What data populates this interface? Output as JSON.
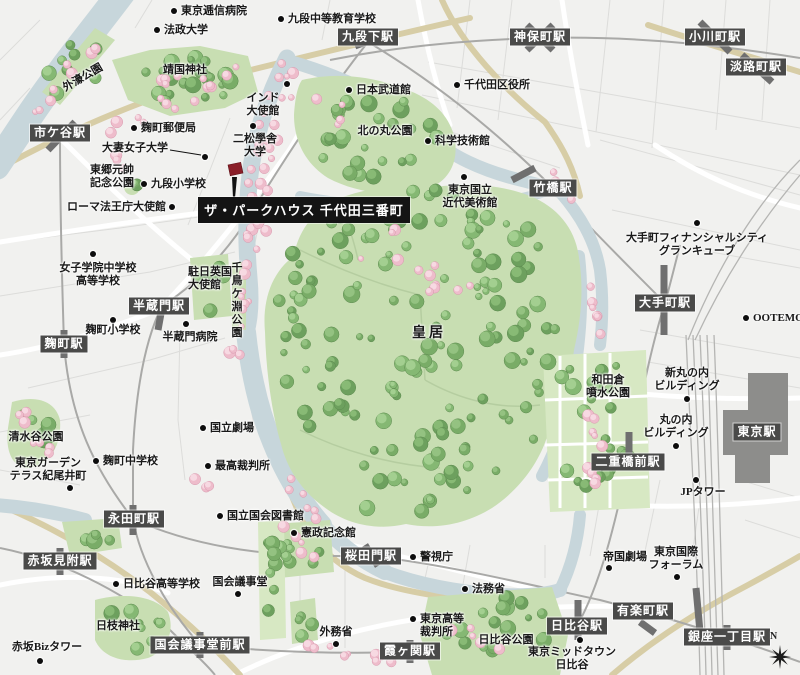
{
  "property": {
    "name": "ザ・パークハウス 千代田三番町",
    "marker_color": "#8a1e28"
  },
  "compass_label": "N",
  "colors": {
    "station_badge": "#4a4a49",
    "water": "#c7d6db",
    "park": "#c8deb2",
    "lawn": "#d7e8c3",
    "tree": "#79ac67",
    "sakura": "#eebccb",
    "major_road": "#d7cda6",
    "railway": "#a9a9a7",
    "station_block": "#8d8d8b",
    "text": "#191919"
  },
  "stations": [
    {
      "id": "ichigaya",
      "label": "市ケ谷駅",
      "x": 60,
      "y": 133
    },
    {
      "id": "kudanshita",
      "label": "九段下駅",
      "x": 368,
      "y": 37
    },
    {
      "id": "jimbocho",
      "label": "神保町駅",
      "x": 540,
      "y": 37
    },
    {
      "id": "ogawamachi",
      "label": "小川町駅",
      "x": 715,
      "y": 37
    },
    {
      "id": "awajicho",
      "label": "淡路町駅",
      "x": 756,
      "y": 67
    },
    {
      "id": "takebashi",
      "label": "竹橋駅",
      "x": 553,
      "y": 188
    },
    {
      "id": "otemachi",
      "label": "大手町駅",
      "x": 665,
      "y": 303
    },
    {
      "id": "tokyo",
      "label": "東京駅",
      "x": 757,
      "y": 432
    },
    {
      "id": "nijubashimae",
      "label": "二重橋前駅",
      "x": 628,
      "y": 462
    },
    {
      "id": "hanzomon",
      "label": "半蔵門駅",
      "x": 159,
      "y": 306
    },
    {
      "id": "kojimachi",
      "label": "麹町駅",
      "x": 64,
      "y": 344
    },
    {
      "id": "nagatacho",
      "label": "永田町駅",
      "x": 134,
      "y": 519
    },
    {
      "id": "akasaka-mitsuke",
      "label": "赤坂見附駅",
      "x": 60,
      "y": 561
    },
    {
      "id": "sakuradamon",
      "label": "桜田門駅",
      "x": 371,
      "y": 556
    },
    {
      "id": "kokkai-gijidomae",
      "label": "国会議事堂前駅",
      "x": 200,
      "y": 645
    },
    {
      "id": "kasumigaseki",
      "label": "霞ヶ関駅",
      "x": 410,
      "y": 651
    },
    {
      "id": "yurakucho",
      "label": "有楽町駅",
      "x": 643,
      "y": 611
    },
    {
      "id": "hibiya",
      "label": "日比谷駅",
      "x": 577,
      "y": 626
    },
    {
      "id": "ginza-itchome",
      "label": "銀座一丁目駅",
      "x": 727,
      "y": 637
    }
  ],
  "landmarks": [
    {
      "id": "tokyo-teishin-hospital",
      "lines": [
        "東京逓信病院"
      ],
      "tx": 181,
      "ty": 5,
      "align": "l",
      "dot": [
        174,
        11
      ]
    },
    {
      "id": "hosei-university",
      "lines": [
        "法政大学"
      ],
      "tx": 164,
      "ty": 24,
      "align": "l",
      "dot": [
        157,
        30
      ]
    },
    {
      "id": "kudan-secondary-school",
      "lines": [
        "九段中等教育学校"
      ],
      "tx": 288,
      "ty": 13,
      "align": "l",
      "dot": [
        281,
        19
      ]
    },
    {
      "id": "chiyoda-ward-office",
      "lines": [
        "千代田区役所"
      ],
      "tx": 464,
      "ty": 79,
      "align": "l",
      "dot": [
        457,
        85
      ]
    },
    {
      "id": "science-museum",
      "lines": [
        "科学技術館"
      ],
      "tx": 435,
      "ty": 135,
      "align": "l",
      "dot": [
        428,
        141
      ]
    },
    {
      "id": "kojimachi-post-office",
      "lines": [
        "麹町郵便局"
      ],
      "tx": 141,
      "ty": 122,
      "align": "l",
      "dot": [
        134,
        128
      ]
    },
    {
      "id": "kudan-elementary-school",
      "lines": [
        "九段小学校"
      ],
      "tx": 151,
      "ty": 178,
      "align": "l",
      "dot": [
        144,
        184
      ]
    },
    {
      "id": "nippon-budokan",
      "lines": [
        "日本武道館"
      ],
      "tx": 356,
      "ty": 84,
      "align": "l",
      "dot": [
        349,
        90
      ]
    },
    {
      "id": "ootemori",
      "lines": [
        "OOTEMORI"
      ],
      "tx": 753,
      "ty": 312,
      "align": "l",
      "dot": [
        746,
        318
      ]
    },
    {
      "id": "kojimachi-junior-high",
      "lines": [
        "麹町中学校"
      ],
      "tx": 103,
      "ty": 455,
      "align": "l",
      "dot": [
        96,
        461
      ]
    },
    {
      "id": "national-theatre",
      "lines": [
        "国立劇場"
      ],
      "tx": 210,
      "ty": 422,
      "align": "l",
      "dot": [
        203,
        428
      ]
    },
    {
      "id": "supreme-court",
      "lines": [
        "最高裁判所"
      ],
      "tx": 215,
      "ty": 460,
      "align": "l",
      "dot": [
        208,
        466
      ]
    },
    {
      "id": "national-diet-library",
      "lines": [
        "国立国会図書館"
      ],
      "tx": 227,
      "ty": 510,
      "align": "l",
      "dot": [
        220,
        516
      ]
    },
    {
      "id": "kensei-memorial-hall",
      "lines": [
        "憲政記念館"
      ],
      "tx": 301,
      "ty": 527,
      "align": "l",
      "dot": [
        294,
        533
      ]
    },
    {
      "id": "metropolitan-police-hq",
      "lines": [
        "警視庁"
      ],
      "tx": 420,
      "ty": 551,
      "align": "l",
      "dot": [
        413,
        557
      ]
    },
    {
      "id": "ministry-of-justice",
      "lines": [
        "法務省"
      ],
      "tx": 472,
      "ty": 583,
      "align": "l",
      "dot": [
        465,
        589
      ]
    },
    {
      "id": "hibiya-high-school",
      "lines": [
        "日比谷高等学校"
      ],
      "tx": 123,
      "ty": 578,
      "align": "l",
      "dot": [
        116,
        584
      ]
    },
    {
      "id": "tokyo-high-court",
      "lines": [
        "東京高等",
        "裁判所"
      ],
      "tx": 420,
      "ty": 613,
      "align": "l",
      "dot": [
        413,
        619
      ]
    },
    {
      "id": "holy-see-embassy",
      "lines": [
        "ローマ法王庁大使館"
      ],
      "tx": 166,
      "ty": 201,
      "align": "r",
      "dot": [
        172,
        207
      ]
    },
    {
      "id": "otsuma-womens-university",
      "lines": [
        "大妻女子大学"
      ],
      "tx": 168,
      "ty": 142,
      "align": "r",
      "dot": [
        205,
        157
      ],
      "line": [
        170,
        150,
        201,
        155
      ]
    },
    {
      "id": "india-embassy",
      "lines": [
        "インド",
        "大使館"
      ],
      "tx": 263,
      "ty": 92,
      "align": "c",
      "dot": [
        287,
        84
      ]
    },
    {
      "id": "nishogakusha-university",
      "lines": [
        "二松學舎",
        "大学"
      ],
      "tx": 255,
      "ty": 133,
      "align": "c",
      "dot": [
        253,
        126
      ]
    },
    {
      "id": "momat-museum",
      "lines": [
        "東京国立",
        "近代美術館"
      ],
      "tx": 470,
      "ty": 184,
      "align": "c",
      "dot": [
        464,
        177
      ]
    },
    {
      "id": "otemachi-financial-city",
      "lines": [
        "大手町フィナンシャルシティ",
        "グランキューブ"
      ],
      "tx": 697,
      "ty": 232,
      "align": "c",
      "dot": [
        697,
        223
      ]
    },
    {
      "id": "joshigakuin-school",
      "lines": [
        "女子学院中学校",
        "高等学校"
      ],
      "tx": 98,
      "ty": 262,
      "align": "c",
      "dot": [
        93,
        254
      ]
    },
    {
      "id": "jp-tower",
      "lines": [
        "JPタワー"
      ],
      "tx": 703,
      "ty": 486,
      "align": "c",
      "dot": [
        696,
        480
      ]
    },
    {
      "id": "hanzomon-hospital",
      "lines": [
        "半蔵門病院"
      ],
      "tx": 190,
      "ty": 331,
      "align": "c",
      "dot": [
        186,
        324
      ]
    },
    {
      "id": "kojimachi-elementary-school",
      "lines": [
        "麹町小学校"
      ],
      "tx": 113,
      "ty": 324,
      "align": "c",
      "dot": [
        113,
        320
      ]
    },
    {
      "id": "midtown-hibiya",
      "lines": [
        "東京ミッドタウン",
        "日比谷"
      ],
      "tx": 572,
      "ty": 646,
      "align": "c",
      "dot": [
        580,
        640
      ]
    },
    {
      "id": "shin-marunouchi-building",
      "lines": [
        "新丸の内",
        "ビルディング"
      ],
      "tx": 687,
      "ty": 367,
      "align": "c",
      "dot": [
        687,
        399
      ]
    },
    {
      "id": "marunouchi-building",
      "lines": [
        "丸の内",
        "ビルディング"
      ],
      "tx": 676,
      "ty": 414,
      "align": "c",
      "dot": [
        676,
        446
      ]
    },
    {
      "id": "national-diet-building",
      "lines": [
        "国会議事堂"
      ],
      "tx": 240,
      "ty": 576,
      "align": "c",
      "dot": [
        238,
        594
      ]
    },
    {
      "id": "ministry-of-foreign-affairs",
      "lines": [
        "外務省"
      ],
      "tx": 336,
      "ty": 626,
      "align": "c",
      "dot": [
        336,
        644
      ]
    },
    {
      "id": "akasaka-biz-tower",
      "lines": [
        "赤坂Bizタワー"
      ],
      "tx": 47,
      "ty": 641,
      "align": "c",
      "dot": [
        40,
        661
      ]
    },
    {
      "id": "tokyo-garden-terrace-kioicho",
      "lines": [
        "東京ガーデン",
        "テラス紀尾井町"
      ],
      "tx": 48,
      "ty": 457,
      "align": "c",
      "dot": [
        70,
        488
      ]
    },
    {
      "id": "imperial-theatre",
      "lines": [
        "帝国劇場"
      ],
      "tx": 625,
      "ty": 551,
      "align": "c",
      "dot": [
        609,
        568
      ]
    },
    {
      "id": "tokyo-international-forum",
      "lines": [
        "東京国際",
        "フォーラム"
      ],
      "tx": 676,
      "ty": 546,
      "align": "c",
      "dot": [
        677,
        577
      ]
    },
    {
      "id": "yasukuni-shrine",
      "lines": [
        "靖国神社"
      ],
      "tx": 185,
      "ty": 64,
      "align": "c"
    },
    {
      "id": "kitanomaru-park",
      "lines": [
        "北の丸公園"
      ],
      "tx": 385,
      "ty": 125,
      "align": "c"
    },
    {
      "id": "imperial-palace",
      "lines": [
        "皇居"
      ],
      "tx": 429,
      "ty": 326,
      "align": "c",
      "size": 14,
      "ls": 3
    },
    {
      "id": "wadakura-fountain-park",
      "lines": [
        "和田倉",
        "噴水公園"
      ],
      "tx": 608,
      "ty": 374,
      "align": "c"
    },
    {
      "id": "shimizudani-park",
      "lines": [
        "清水谷公園"
      ],
      "tx": 36,
      "ty": 431,
      "align": "c"
    },
    {
      "id": "hie-shrine",
      "lines": [
        "日枝神社"
      ],
      "tx": 118,
      "ty": 620,
      "align": "c"
    },
    {
      "id": "hibiya-park",
      "lines": [
        "日比谷公園"
      ],
      "tx": 506,
      "ty": 634,
      "align": "c"
    },
    {
      "id": "togo-memorial-park",
      "lines": [
        "東郷元帥",
        "記念公園"
      ],
      "tx": 90,
      "ty": 164,
      "align": "l"
    },
    {
      "id": "uk-embassy",
      "lines": [
        "駐日英国",
        "大使館"
      ],
      "tx": 188,
      "ty": 266,
      "align": "l"
    },
    {
      "id": "sotobori-park",
      "lines": [
        "外濠公園"
      ],
      "tx": 83,
      "ty": 78,
      "align": "c",
      "rot": -30
    },
    {
      "id": "chidorigafuchi-park",
      "lines": [
        "千鳥ケ淵公園"
      ],
      "tx": 237,
      "ty": 262,
      "align": "c",
      "v": true
    }
  ]
}
